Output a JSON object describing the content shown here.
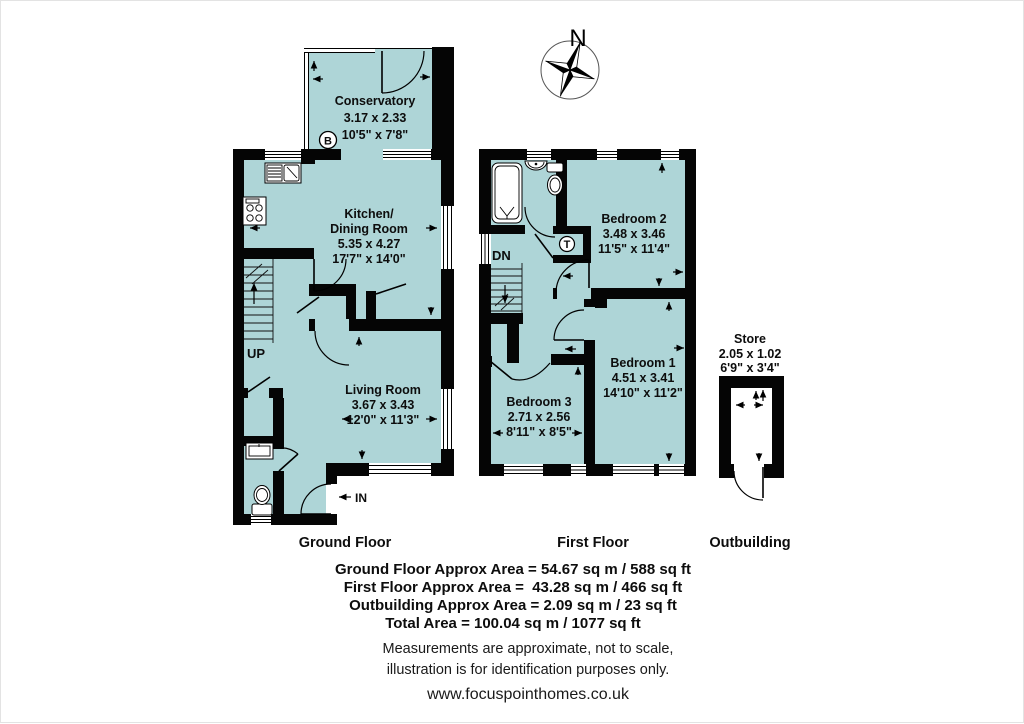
{
  "colors": {
    "room_fill": "#aed5d7",
    "wall": "#050505"
  },
  "compass": {
    "north_label": "N"
  },
  "ground": {
    "label": "Ground Floor",
    "up": "UP",
    "in": "IN",
    "boiler": "B",
    "conservatory": {
      "name": "Conservatory",
      "metric": "3.17 x 2.33",
      "imperial": "10'5\" x 7'8\""
    },
    "kitchen": {
      "name1": "Kitchen/",
      "name2": "Dining Room",
      "metric": "5.35 x 4.27",
      "imperial": "17'7\" x 14'0\""
    },
    "living": {
      "name": "Living Room",
      "metric": "3.67 x 3.43",
      "imperial": "12'0\" x 11'3\""
    }
  },
  "first": {
    "label": "First Floor",
    "dn": "DN",
    "tank": "T",
    "bedroom2": {
      "name": "Bedroom 2",
      "metric": "3.48 x 3.46",
      "imperial": "11'5\" x 11'4\""
    },
    "bedroom1": {
      "name": "Bedroom 1",
      "metric": "4.51 x 3.41",
      "imperial": "14'10\" x 11'2\""
    },
    "bedroom3": {
      "name": "Bedroom 3",
      "metric": "2.71 x 2.56",
      "imperial": "8'11\" x 8'5\""
    }
  },
  "outbuilding": {
    "label": "Outbuilding",
    "store": {
      "name": "Store",
      "metric": "2.05 x 1.02",
      "imperial": "6'9\" x 3'4\""
    }
  },
  "areas": {
    "ground": "Ground Floor Approx Area = 54.67 sq m / 588 sq ft",
    "first": "First Floor Approx Area =  43.28 sq m / 466 sq ft",
    "outbuilding": "Outbuilding Approx Area = 2.09 sq m / 23 sq ft",
    "total": "Total Area = 100.04 sq m / 1077 sq ft"
  },
  "disclaimer": {
    "line1": "Measurements are approximate, not to scale,",
    "line2": "illustration is for identification purposes only.",
    "website": "www.focuspointhomes.co.uk"
  }
}
